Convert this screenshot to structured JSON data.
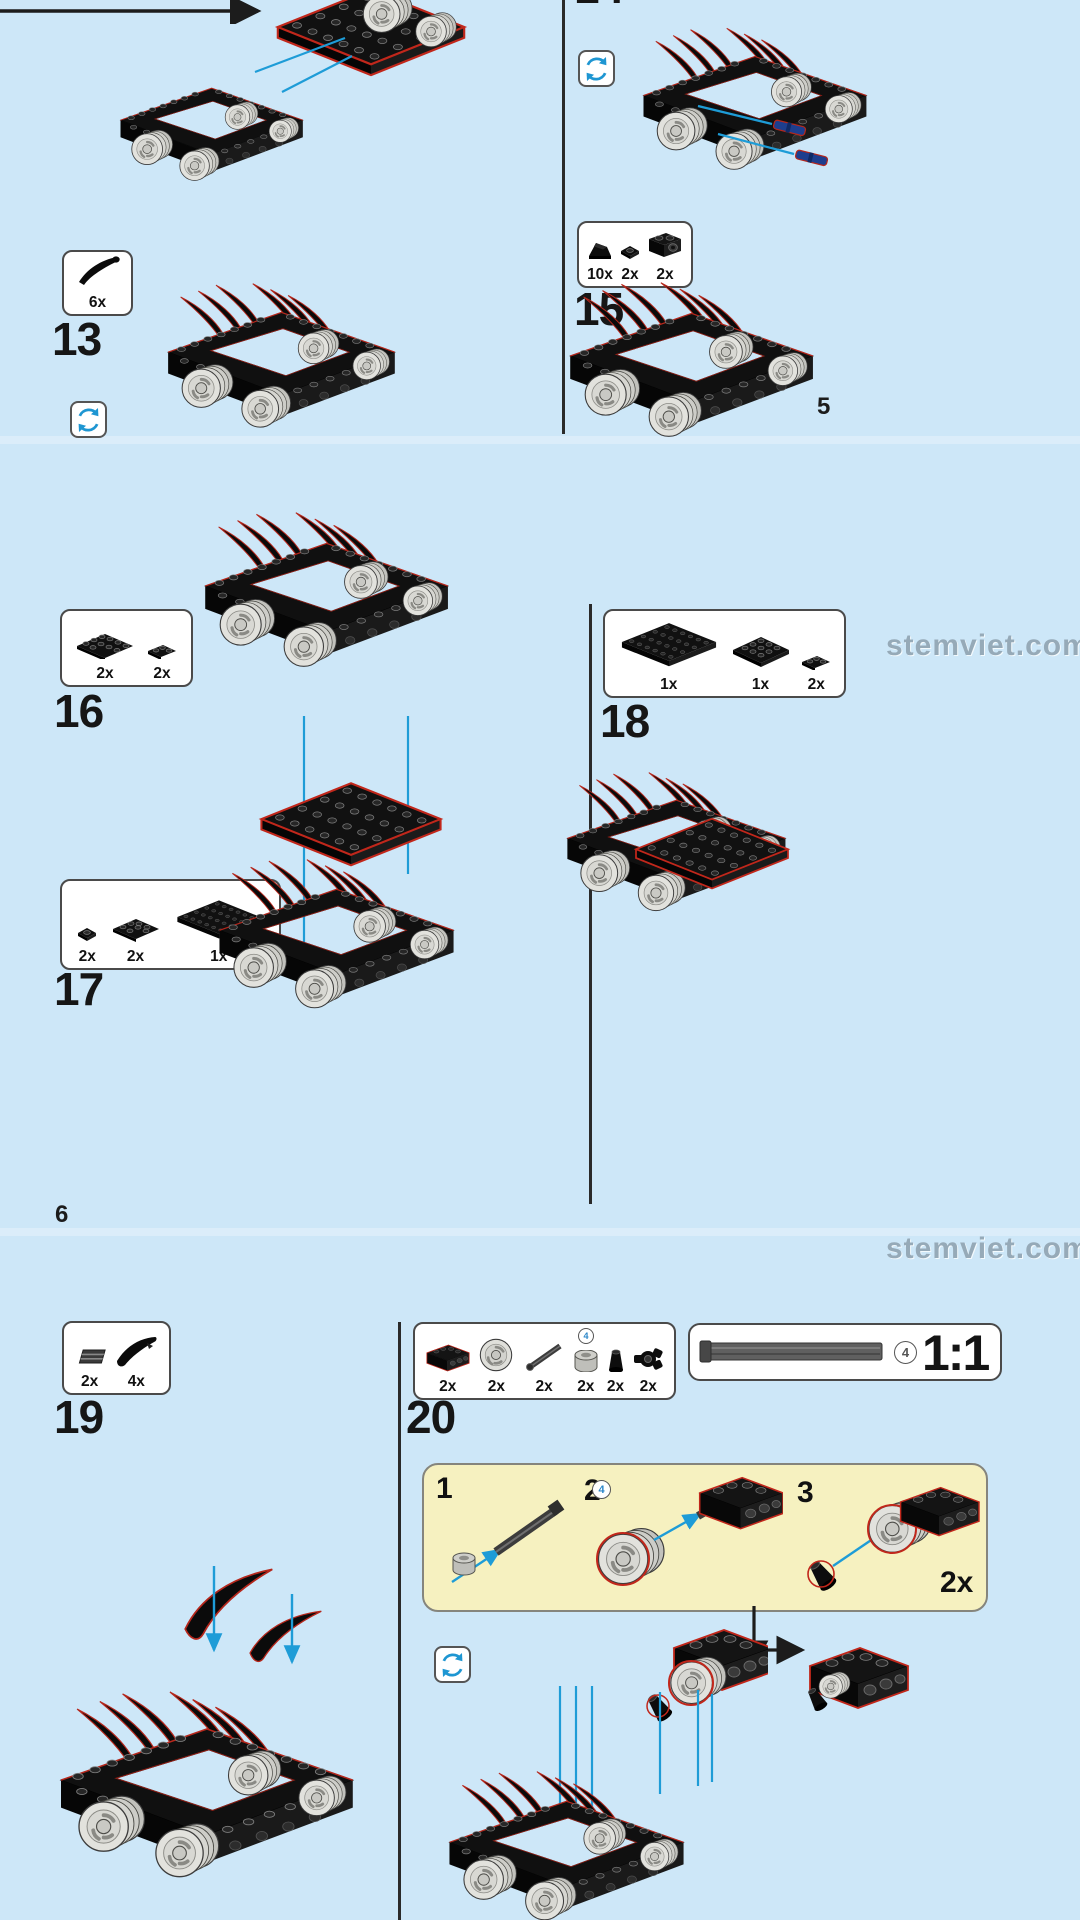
{
  "watermark": "stemviet.com",
  "page5": {
    "page_number": "5",
    "step13": {
      "number": "13",
      "parts": [
        {
          "name": "horn-claw",
          "count": "6x"
        }
      ]
    },
    "step14": {
      "number": "14"
    },
    "step15": {
      "number": "15",
      "parts": [
        {
          "name": "slope-brick-1x1",
          "count": "10x"
        },
        {
          "name": "plate-1x1",
          "count": "2x"
        },
        {
          "name": "technic-brick-1x2",
          "count": "2x"
        }
      ]
    }
  },
  "page6": {
    "page_number": "6",
    "step16": {
      "number": "16",
      "parts": [
        {
          "name": "plate-2x6",
          "count": "2x"
        },
        {
          "name": "plate-1x3",
          "count": "2x"
        }
      ]
    },
    "step17": {
      "number": "17",
      "parts": [
        {
          "name": "plate-1x1",
          "count": "2x"
        },
        {
          "name": "plate-2x4",
          "count": "2x"
        },
        {
          "name": "plate-4x6",
          "count": "1x"
        }
      ]
    },
    "step18": {
      "number": "18",
      "parts": [
        {
          "name": "plate-6x4",
          "count": "1x"
        },
        {
          "name": "plate-4x4",
          "count": "1x"
        },
        {
          "name": "plate-1x3",
          "count": "2x"
        }
      ]
    }
  },
  "page7": {
    "step19": {
      "number": "19",
      "parts": [
        {
          "name": "grille-tile-1x2",
          "count": "2x"
        },
        {
          "name": "curved-slope",
          "count": "4x"
        }
      ]
    },
    "step20": {
      "number": "20",
      "parts": [
        {
          "name": "technic-brick-1x4",
          "count": "2x"
        },
        {
          "name": "pulley-wheel",
          "count": "2x"
        },
        {
          "name": "axle-4",
          "count": "2x"
        },
        {
          "name": "bush",
          "count": "2x"
        },
        {
          "name": "cone",
          "count": "2x"
        },
        {
          "name": "pin-connector",
          "count": "2x"
        }
      ]
    },
    "scale_callout": {
      "axle_badge": "4",
      "label": "1:1"
    },
    "subassembly_box": {
      "step1": "1",
      "step2": "2",
      "step3": "3",
      "axle_badge": "4",
      "multiplier": "2x"
    }
  }
}
